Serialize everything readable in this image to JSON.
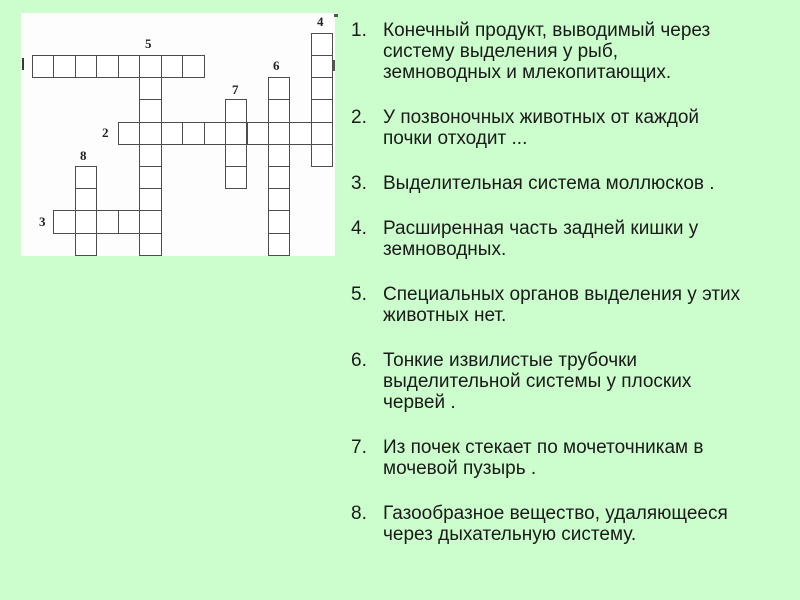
{
  "slide": {
    "background_color": "#ccfdcc",
    "text_color": "#1a1a1a"
  },
  "crossword": {
    "board_color": "#fdfdfd",
    "grid_line_color": "#4d4d4d",
    "words": [
      {
        "number": "1",
        "direction": "across",
        "col": 0,
        "row": 1,
        "length": 8,
        "label_clipped": true
      },
      {
        "number": "2",
        "direction": "across",
        "col": 4,
        "row": 4,
        "length": 10
      },
      {
        "number": "3",
        "direction": "across",
        "col": 1,
        "row": 8,
        "length": 5
      },
      {
        "number": "4",
        "direction": "down",
        "col": 13,
        "row": 0,
        "length": 6
      },
      {
        "number": "5",
        "direction": "down",
        "col": 5,
        "row": 1,
        "length": 9
      },
      {
        "number": "6",
        "direction": "down",
        "col": 11,
        "row": 2,
        "length": 8
      },
      {
        "number": "7",
        "direction": "down",
        "col": 9,
        "row": 3,
        "length": 4
      },
      {
        "number": "8",
        "direction": "down",
        "col": 2,
        "row": 6,
        "length": 4
      }
    ]
  },
  "clues": [
    {
      "number": "1.",
      "lines": [
        "Конечный продукт, выводимый через",
        "систему выделения у рыб,",
        "земноводных и млекопитающих."
      ]
    },
    {
      "number": "2.",
      "lines": [
        "У позвоночных животных от каждой",
        "почки отходит ..."
      ]
    },
    {
      "number": "3.",
      "lines": [
        "Выделительная система моллюсков ."
      ]
    },
    {
      "number": "4.",
      "lines": [
        "Расширенная часть задней кишки у",
        "земноводных."
      ]
    },
    {
      "number": "5.",
      "lines": [
        "Специальных органов выделения у этих",
        "животных нет."
      ]
    },
    {
      "number": "6.",
      "lines": [
        "Тонкие извилистые трубочки",
        "выделительной системы у плоских",
        "червей ."
      ]
    },
    {
      "number": "7.",
      "lines": [
        "Из почек стекает по мочеточникам в",
        "мочевой пузырь ."
      ]
    },
    {
      "number": "8.",
      "lines": [
        "Газообразное вещество, удаляющееся",
        "через дыхательную систему."
      ]
    }
  ]
}
